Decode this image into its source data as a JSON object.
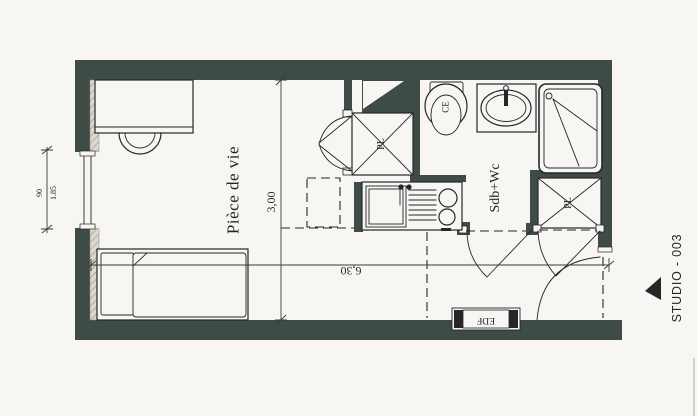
{
  "labels": {
    "living_room": "Pièce de vie",
    "bathroom": "Sdb+Wc",
    "closet_1": "PL",
    "closet_2": "PL",
    "water_heater": "CE",
    "electric_meter": "EDF",
    "plan_title": "STUDIO - 003"
  },
  "dimensions": {
    "overall_width": "6,30",
    "living_depth": "3,00",
    "window_sill_height": "90",
    "window_width": "1.85"
  },
  "colors": {
    "wall": "#3e4b47",
    "line": "#26262a",
    "paper": "#f7f6f2",
    "hatch": "#dcd8d0"
  }
}
